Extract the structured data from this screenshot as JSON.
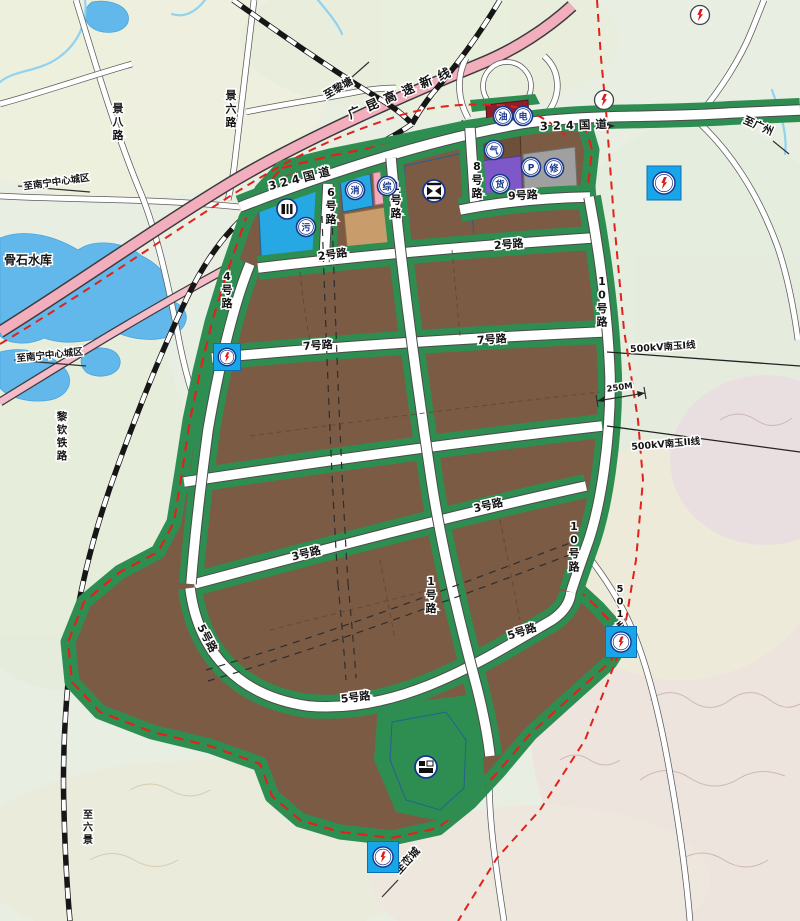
{
  "map_title": "industrial park land-use planning map",
  "colors": {
    "background": "#e9eee3",
    "industrial_brown": "#7c5b45",
    "greenbelt": "#2e8e52",
    "public_blue": "#25a8e3",
    "logistics_purple": "#7e57c8",
    "parking_gray": "#a0a0a0",
    "service_pink": "#f2aab8",
    "commercial_khaki": "#c89c6b",
    "fuel_maroon": "#8e1e2a",
    "water": "#62b8ea",
    "highway_pink": "#f2aebd",
    "boundary_red": "#e32119",
    "substation_cyan": "#18a6e8",
    "icon_ring_blue": "#16368e",
    "bolt_red": "#e01818"
  },
  "road_labels": [
    {
      "text": "324国道",
      "x": 302,
      "y": 182,
      "angle": -14,
      "size": 11.5,
      "ls": 4
    },
    {
      "text": "324国道",
      "x": 576,
      "y": 129,
      "angle": -2,
      "size": 11.5,
      "ls": 5
    },
    {
      "text": "2号路",
      "x": 333,
      "y": 258,
      "angle": -8,
      "size": 11
    },
    {
      "text": "2号路",
      "x": 509,
      "y": 248,
      "angle": -5,
      "size": 11
    },
    {
      "text": "7号路",
      "x": 318,
      "y": 349,
      "angle": -4,
      "size": 11
    },
    {
      "text": "7号路",
      "x": 492,
      "y": 343,
      "angle": -4,
      "size": 11
    },
    {
      "text": "3号路",
      "x": 307,
      "y": 557,
      "angle": -14,
      "size": 11
    },
    {
      "text": "3号路",
      "x": 489,
      "y": 509,
      "angle": -13,
      "size": 11
    },
    {
      "text": "5号路",
      "x": 204,
      "y": 640,
      "angle": 62,
      "size": 11
    },
    {
      "text": "5号路",
      "x": 356,
      "y": 701,
      "angle": -7,
      "size": 11
    },
    {
      "text": "5号路",
      "x": 523,
      "y": 635,
      "angle": -18,
      "size": 11
    },
    {
      "text": "9号路",
      "x": 523,
      "y": 199,
      "angle": -3,
      "size": 11
    },
    {
      "text": "1号路",
      "x": 396,
      "y": 190,
      "vertical": true,
      "size": 11
    },
    {
      "text": "1号路",
      "x": 431,
      "y": 585,
      "vertical": true,
      "size": 11
    },
    {
      "text": "4号路",
      "x": 227,
      "y": 280,
      "vertical": true,
      "size": 11
    },
    {
      "text": "6号路",
      "x": 331,
      "y": 196,
      "vertical": true,
      "size": 11
    },
    {
      "text": "8号路",
      "x": 477,
      "y": 170,
      "vertical": true,
      "size": 11
    },
    {
      "text": "10号路",
      "x": 602,
      "y": 285,
      "vertical": true,
      "size": 11
    },
    {
      "text": "10号路",
      "x": 574,
      "y": 530,
      "vertical": true,
      "size": 11
    },
    {
      "text": "景六路",
      "x": 231,
      "y": 99,
      "vertical": true,
      "size": 11
    },
    {
      "text": "景八路",
      "x": 118,
      "y": 112,
      "vertical": true,
      "size": 11
    },
    {
      "text": "501乡道",
      "x": 620,
      "y": 592,
      "vertical": true,
      "size": 10
    }
  ],
  "place_labels": [
    {
      "text": "至南宁中心城区",
      "x": 57,
      "y": 185,
      "angle": -8,
      "size": 9.5
    },
    {
      "text": "至南宁中心城区",
      "x": 50,
      "y": 358,
      "angle": -6,
      "size": 9.5
    },
    {
      "text": "至黎塘",
      "x": 340,
      "y": 91,
      "angle": -30,
      "size": 10.5
    },
    {
      "text": "至广州",
      "x": 757,
      "y": 129,
      "angle": 24,
      "size": 10.5
    },
    {
      "text": "至峦城",
      "x": 410,
      "y": 863,
      "angle": -48,
      "size": 10.5
    },
    {
      "text": "至六景",
      "x": 88,
      "y": 818,
      "vertical": true,
      "size": 10
    },
    {
      "text": "骨石水库",
      "x": 28,
      "y": 264,
      "angle": 0,
      "size": 12
    },
    {
      "text": "黎钦铁路",
      "x": 62,
      "y": 420,
      "vertical": true,
      "size": 10.5
    },
    {
      "text": "广昆高速新线",
      "x": 404,
      "y": 96,
      "angle": -23,
      "size": 12.5,
      "ls": 7
    },
    {
      "text": "500kV南玉I线",
      "x": 663,
      "y": 350,
      "angle": -4,
      "size": 9.5
    },
    {
      "text": "500kV南玉II线",
      "x": 666,
      "y": 447,
      "angle": -5,
      "size": 9.5
    },
    {
      "text": "250M",
      "x": 620,
      "y": 390,
      "angle": -8,
      "size": 8.5
    }
  ],
  "markers": {
    "circle_icons": [
      {
        "ch": "污",
        "name": "sewage-plant-icon",
        "x": 306,
        "y": 227
      },
      {
        "ch": "消",
        "name": "fire-station-icon",
        "x": 355,
        "y": 190
      },
      {
        "ch": "综",
        "name": "mixed-service-icon",
        "x": 387,
        "y": 186
      },
      {
        "ch": "气",
        "name": "gas-station-icon",
        "x": 494,
        "y": 150
      },
      {
        "ch": "货",
        "name": "freight-icon",
        "x": 500,
        "y": 184
      },
      {
        "ch": "P",
        "name": "parking-icon",
        "x": 531,
        "y": 167
      },
      {
        "ch": "修",
        "name": "vehicle-repair-icon",
        "x": 554,
        "y": 168
      },
      {
        "ch": "油",
        "name": "fuel-station-icon",
        "x": 503,
        "y": 116
      },
      {
        "ch": "电",
        "name": "electric-icon",
        "x": 523,
        "y": 116
      }
    ],
    "substations": [
      {
        "x": 664,
        "y": 183,
        "s": 34
      },
      {
        "x": 227,
        "y": 357,
        "s": 27
      },
      {
        "x": 621,
        "y": 642,
        "s": 31
      },
      {
        "x": 383,
        "y": 857,
        "s": 31
      }
    ],
    "towers": [
      {
        "x": 604,
        "y": 100
      },
      {
        "x": 700,
        "y": 15
      }
    ],
    "special": [
      {
        "kind": "storage",
        "name": "warehouse-icon",
        "x": 287,
        "y": 209
      },
      {
        "kind": "bus",
        "name": "bus-terminal-icon",
        "x": 434,
        "y": 191
      },
      {
        "kind": "freight",
        "name": "freight-yard-icon",
        "x": 426,
        "y": 767
      }
    ]
  }
}
